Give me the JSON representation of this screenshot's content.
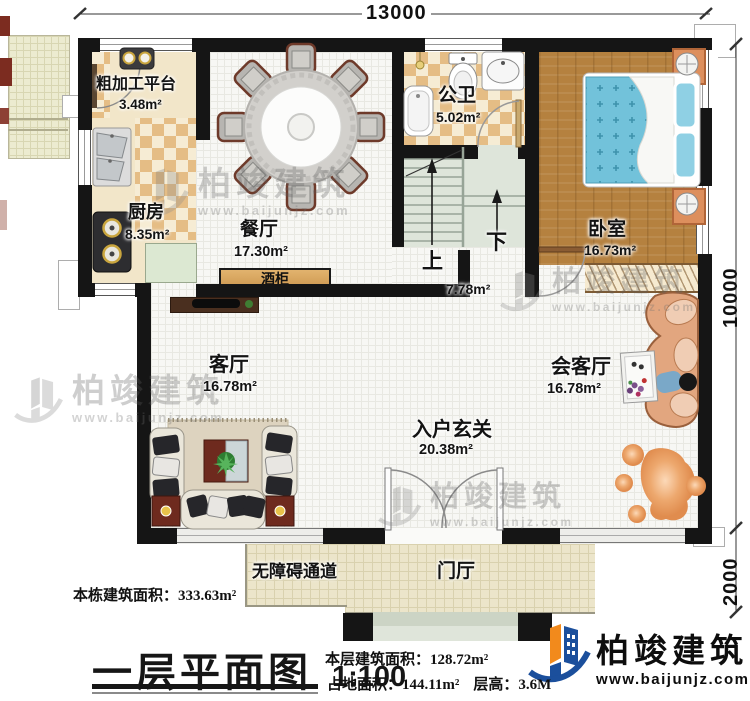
{
  "dims": {
    "top": "13000",
    "right": "10000",
    "porch": "2000"
  },
  "rooms": {
    "rough_platform": {
      "label": "粗加工平台",
      "area": "3.48m²"
    },
    "kitchen": {
      "label": "厨房",
      "area": "8.35m²"
    },
    "dining": {
      "label": "餐厅",
      "area": "17.30m²"
    },
    "bath": {
      "label": "公卫",
      "area": "5.02m²"
    },
    "bedroom": {
      "label": "卧室",
      "area": "16.73m²"
    },
    "stair": {
      "up": "上",
      "down": "下",
      "area": "7.78m²"
    },
    "living": {
      "label": "客厅",
      "area": "16.78m²"
    },
    "reception": {
      "label": "会客厅",
      "area": "16.78m²"
    },
    "entry": {
      "label": "入户玄关",
      "area": "20.38m²"
    },
    "wine": {
      "label": "酒柜"
    },
    "foyer": {
      "label": "门厅"
    },
    "ramp": {
      "label": "无障碍通道"
    }
  },
  "notes": {
    "total_area": "本栋建筑面积：333.63m²",
    "floor_area": "本层建筑面积：128.72m²",
    "land_area": "占地面积：144.11m²",
    "floor_height": "层高：3.6M",
    "title": "一层平面图",
    "scale": "1:100"
  },
  "brand": {
    "name": "柏竣建筑",
    "website": "www.baijunjz.com"
  }
}
